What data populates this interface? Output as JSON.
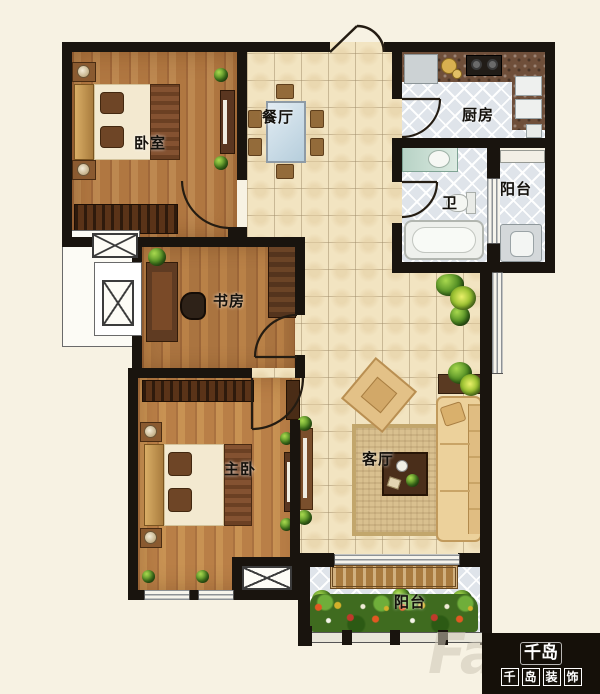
{
  "title": "apartment-floor-plan",
  "rooms": {
    "bedroom": {
      "label": "卧室"
    },
    "dining": {
      "label": "餐厅"
    },
    "kitchen": {
      "label": "厨房"
    },
    "bathroom": {
      "label": "卫"
    },
    "balcony_right": {
      "label": "阳台"
    },
    "study": {
      "label": "书房"
    },
    "master": {
      "label": "主卧"
    },
    "living": {
      "label": "客厅"
    },
    "balcony_bottom": {
      "label": "阳台"
    }
  },
  "branding": {
    "watermark": "Fa",
    "logo_mark": "千岛",
    "logo_chars": [
      "千",
      "岛",
      "装",
      "饰"
    ]
  },
  "colors": {
    "wall": "#19140e",
    "tile_beige": "#f2e4c1",
    "tile_blue": "#dfe4ea",
    "wood": "#b98147",
    "background": "#f7f2e3",
    "logo_bg": "#151009"
  }
}
